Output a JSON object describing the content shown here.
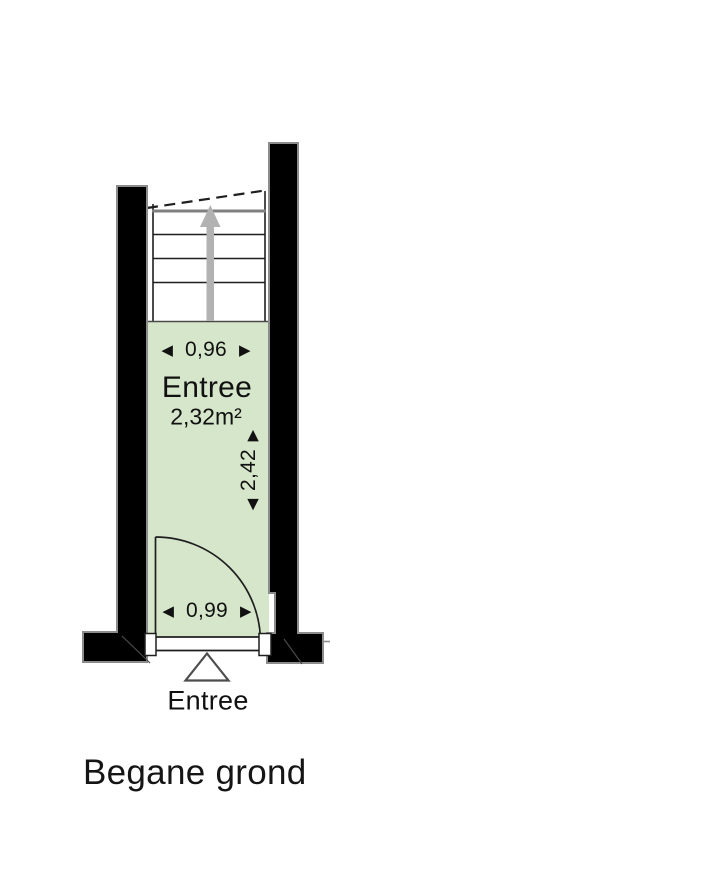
{
  "floor_plan": {
    "title": "Begane grond",
    "room": {
      "name": "Entree",
      "area": "2,32m²",
      "dim_width_top": "0,96",
      "dim_height": "2,42",
      "dim_width_bottom": "0,99"
    },
    "entrance_label": "Entree",
    "stairs": {
      "direction": "up",
      "tread_count": 4
    },
    "icons": {
      "dim_left": "◀",
      "dim_right": "▶",
      "dim_up": "▲",
      "dim_down": "▼",
      "stairs_up_arrow": "gray-up-arrow",
      "entrance_marker": "outlined-up-triangle"
    },
    "colors": {
      "background": "#ffffff",
      "room_fill": "#d6e6cb",
      "wall_fill": "#000000",
      "wall_outline": "#8c8c8c",
      "stair_landing_line": "#808080",
      "stairs_arrow": "#b2b2b2",
      "line": "#1f1f1f",
      "text": "#111111"
    }
  }
}
